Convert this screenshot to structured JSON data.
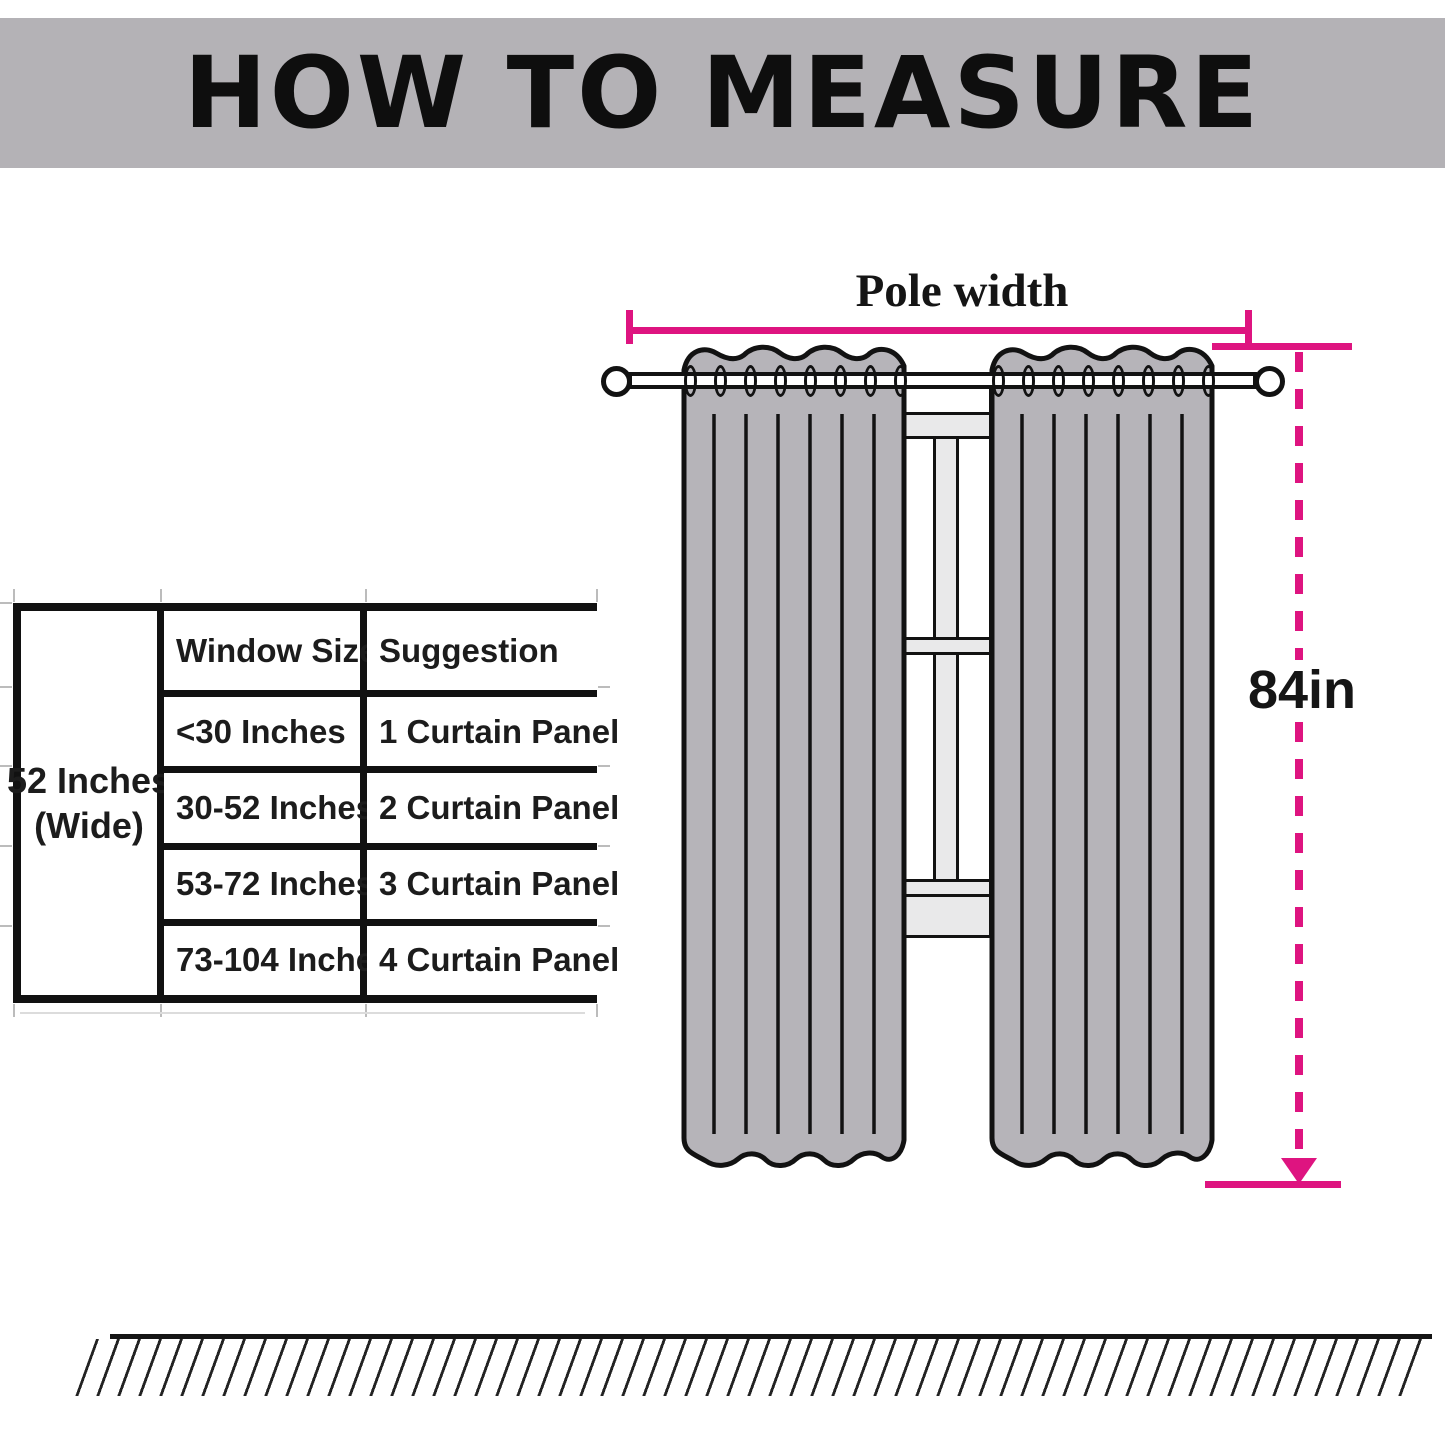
{
  "header": {
    "title": "HOW TO MEASURE",
    "background_color": "#b4b2b6"
  },
  "diagram": {
    "pole_width_label": "Pole width",
    "height_label": "84in",
    "accent_color": "#de1480",
    "curtain_color": "#b6b4b9",
    "window_frame_color": "#e9e9ea"
  },
  "table": {
    "side_label_line1": "52 Inches",
    "side_label_line2": "(Wide)",
    "columns": [
      "Window Size",
      "Suggestion"
    ],
    "rows": [
      {
        "size": "<30 Inches",
        "suggestion": "1 Curtain Panel"
      },
      {
        "size": "30-52 Inches",
        "suggestion": "2 Curtain Panel"
      },
      {
        "size": "53-72 Inches",
        "suggestion": "3 Curtain Panel"
      },
      {
        "size": "73-104 Inches",
        "suggestion": "4 Curtain Panel"
      }
    ]
  }
}
